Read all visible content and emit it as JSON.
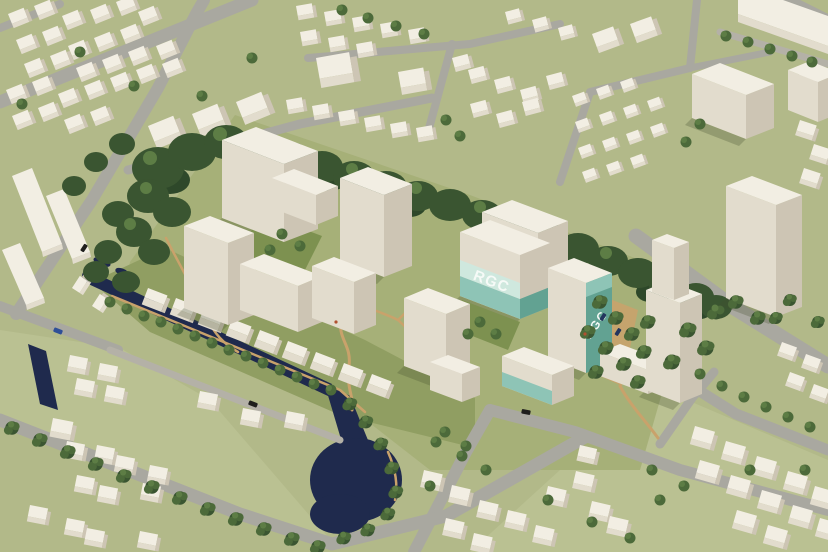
{
  "scene": {
    "type": "aerial-3d-architectural-massing-render",
    "description": "Aerial view of an urban masterplan: cream building masses around courtyards, dense tree rows, a dark navy canal with pond, and a development cluster with teal facade bands labeled RGC.",
    "signs": [
      {
        "text": "RGC",
        "placement": "front facade band, horizontal"
      },
      {
        "text": "RGC",
        "placement": "side facade band, rotated"
      }
    ],
    "colors": {
      "grass": "#b2b989",
      "grass_light": "#bac192",
      "lawn": "#a6b078",
      "park": "#909e62",
      "courtyard_lawn": "#7d9150",
      "water": "#1f2a4d",
      "road": "#a9a8a0",
      "lane": "#b4b1a7",
      "path_tan": "#c9a26b",
      "bld_top": "#f2eee3",
      "bld_front": "#e2dccd",
      "bld_side": "#cdc5b4",
      "tree_dark": "#3a5531",
      "tree_mid": "#4c6a3a",
      "tree_light": "#5d7d45",
      "teal_light": "#cfe8de",
      "teal": "#8ec4b6",
      "teal_dark": "#62a292",
      "sign_text": "#f6faf7",
      "car_blue": "#2f4f97",
      "car_black": "#1f1f1d",
      "car_navy": "#23355e"
    }
  }
}
